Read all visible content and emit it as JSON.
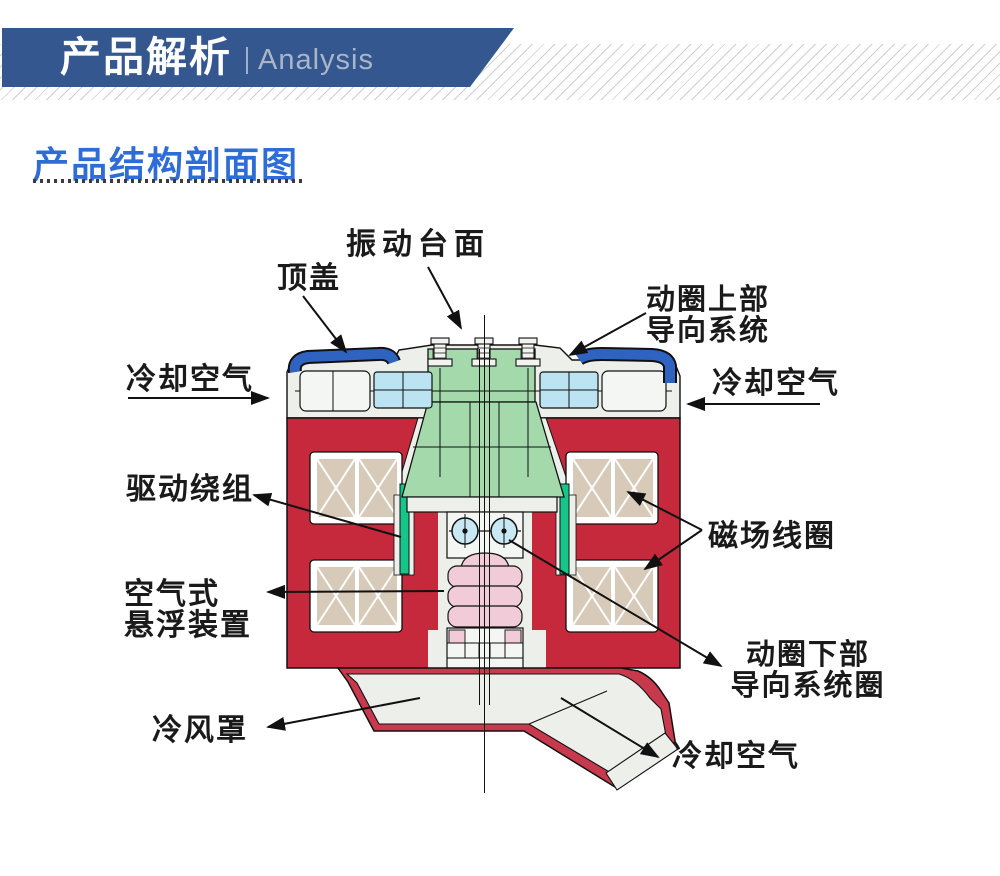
{
  "header": {
    "title_cn": "产品解析",
    "divider": "|",
    "title_en": "Analysis"
  },
  "section": {
    "title": "产品结构剖面图"
  },
  "diagram": {
    "labels": {
      "table_surface": "振动台面",
      "top_cover": "顶盖",
      "upper_guide_line1": "动圈上部",
      "upper_guide_line2": "导向系统",
      "cooling_air_left": "冷却空气",
      "cooling_air_right": "冷却空气",
      "drive_winding": "驱动绕组",
      "field_coil": "磁场线圈",
      "air_suspension_line1": "空气式",
      "air_suspension_line2": "悬浮装置",
      "lower_guide_line1": "动圈下部",
      "lower_guide_line2": "导向系统圈",
      "cooling_hood": "冷风罩",
      "cooling_air_bottom": "冷却空气"
    }
  },
  "colors": {
    "banner_blue": "#33578e",
    "title_blue": "#2e6cd8",
    "body_red": "#c5293b",
    "hood_red": "#c9394d",
    "coil_tan": "#d7cab8",
    "armature_green": "#a4d9ab",
    "guide_green": "#15c68b",
    "bearing_blue": "#bce3f2",
    "cover_blue": "#2f63c2",
    "suspension_pink": "#f2cbd8",
    "label_black": "#1a1a1a"
  }
}
